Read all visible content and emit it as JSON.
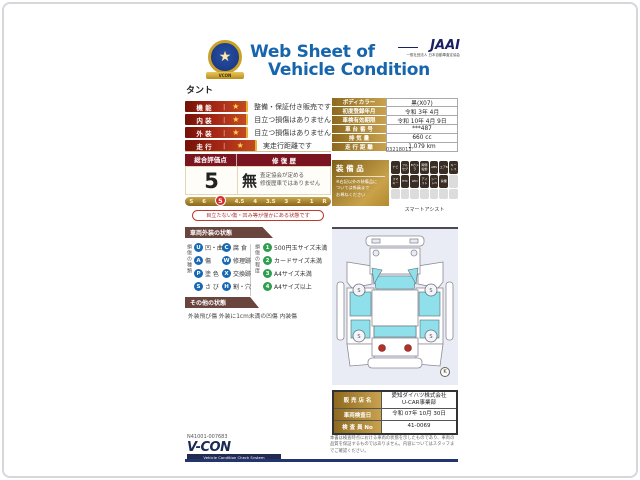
{
  "header": {
    "title_line1": "Web Sheet of",
    "title_line2": "Vehicle Condition",
    "emblem_star": "★",
    "emblem_ribbon": "VCON",
    "jaai_logo": "JAAI",
    "jaai_sub": "一般社団法人 日本自動車査定協会"
  },
  "vehicle_name": "タント",
  "ratings": [
    {
      "label": "機 能",
      "star": "★",
      "desc": "整備・保証付き販売です"
    },
    {
      "label": "内 装",
      "star": "★",
      "desc": "目立つ損傷はありません"
    },
    {
      "label": "外 装",
      "star": "★",
      "desc": "目立つ損傷はありません"
    },
    {
      "label": "走 行",
      "star": "★",
      "desc": "実走行距離です"
    }
  ],
  "evaluation": {
    "score_header": "総合評価点",
    "repair_header": "修 復 歴",
    "score": "5",
    "repair_none": "無",
    "repair_desc": "査定協会が定める\n修復歴車ではありません",
    "scale": [
      "S",
      "6",
      "5",
      "4.5",
      "4",
      "3.5",
      "3",
      "2",
      "1",
      "R"
    ],
    "selected": "5",
    "balloon": "目立たない傷・凹み等が僅かにある状態です"
  },
  "spec_table": {
    "rows": [
      {
        "label": "ボディカラー",
        "value": "黒(X07)"
      },
      {
        "label": "初度登録年月",
        "value": "令和 3年 4月"
      },
      {
        "label": "車検有効期限",
        "value": "令和 10年 4月 9日"
      },
      {
        "label": "車 台 番 号",
        "value": "***487"
      },
      {
        "label": "排  気  量",
        "value": "660 cc"
      },
      {
        "label": "走 行 距 離",
        "value": "1,079 km"
      }
    ],
    "serial": "03218013"
  },
  "equipment": {
    "title": "装 備 品",
    "note": "※右記以外の装備品に\nついては係員まで\nお尋ねください",
    "badges_row1": [
      "ナビ",
      "フル​セグ",
      "Bカ​メラ",
      "両側​電動",
      "ABS",
      "エアB",
      "キー​レス"
    ],
    "badges_row2": [
      "スマ​キー",
      "ETC",
      "LED",
      "アイ​スト",
      "シー​トH",
      "禁煙"
    ],
    "footnote": "スマートアシスト"
  },
  "exterior": {
    "section_title": "車両外装の状態",
    "type_title": "損傷の種類",
    "degree_title": "損傷の程度",
    "damage_types": [
      {
        "code": "U",
        "label": "凹・曲"
      },
      {
        "code": "C",
        "label": "腐 食"
      },
      {
        "code": "A",
        "label": "傷"
      },
      {
        "code": "W",
        "label": "修理跡"
      },
      {
        "code": "P",
        "label": "塗 色"
      },
      {
        "code": "X",
        "label": "交換跡"
      },
      {
        "code": "S",
        "label": "さ び"
      },
      {
        "code": "H",
        "label": "割・穴"
      }
    ],
    "damage_degrees": [
      {
        "code": "1",
        "label": "500円玉サイズ未満"
      },
      {
        "code": "2",
        "label": "カードサイズ未満"
      },
      {
        "code": "3",
        "label": "A4サイズ未満"
      },
      {
        "code": "4",
        "label": "A4サイズ以上"
      }
    ],
    "other_title": "その他の状態",
    "other_text": "外装飛び傷 外装に1cm未満の凹傷 内装傷"
  },
  "diagram": {
    "corner_mark": "K",
    "wheel_mark": "S"
  },
  "sales": {
    "rows": [
      {
        "label": "販 売 店 名",
        "value": "愛知ダイハツ株式会社\nU-CAR事業部"
      },
      {
        "label": "車両検査日",
        "value": "令和 07年 10月 30日"
      },
      {
        "label": "検 査 員 No",
        "value": "41-0069"
      }
    ]
  },
  "footer": {
    "serial": "N41001-007683",
    "vcon": "V-CON",
    "vcon_sub": "Vehicle Condition Check System",
    "disclaimer": "本書は検査時点における車両の状態を示したものであり、車両の品質を保証するものではありません。内容についてはスタッフまでご確認ください。"
  }
}
